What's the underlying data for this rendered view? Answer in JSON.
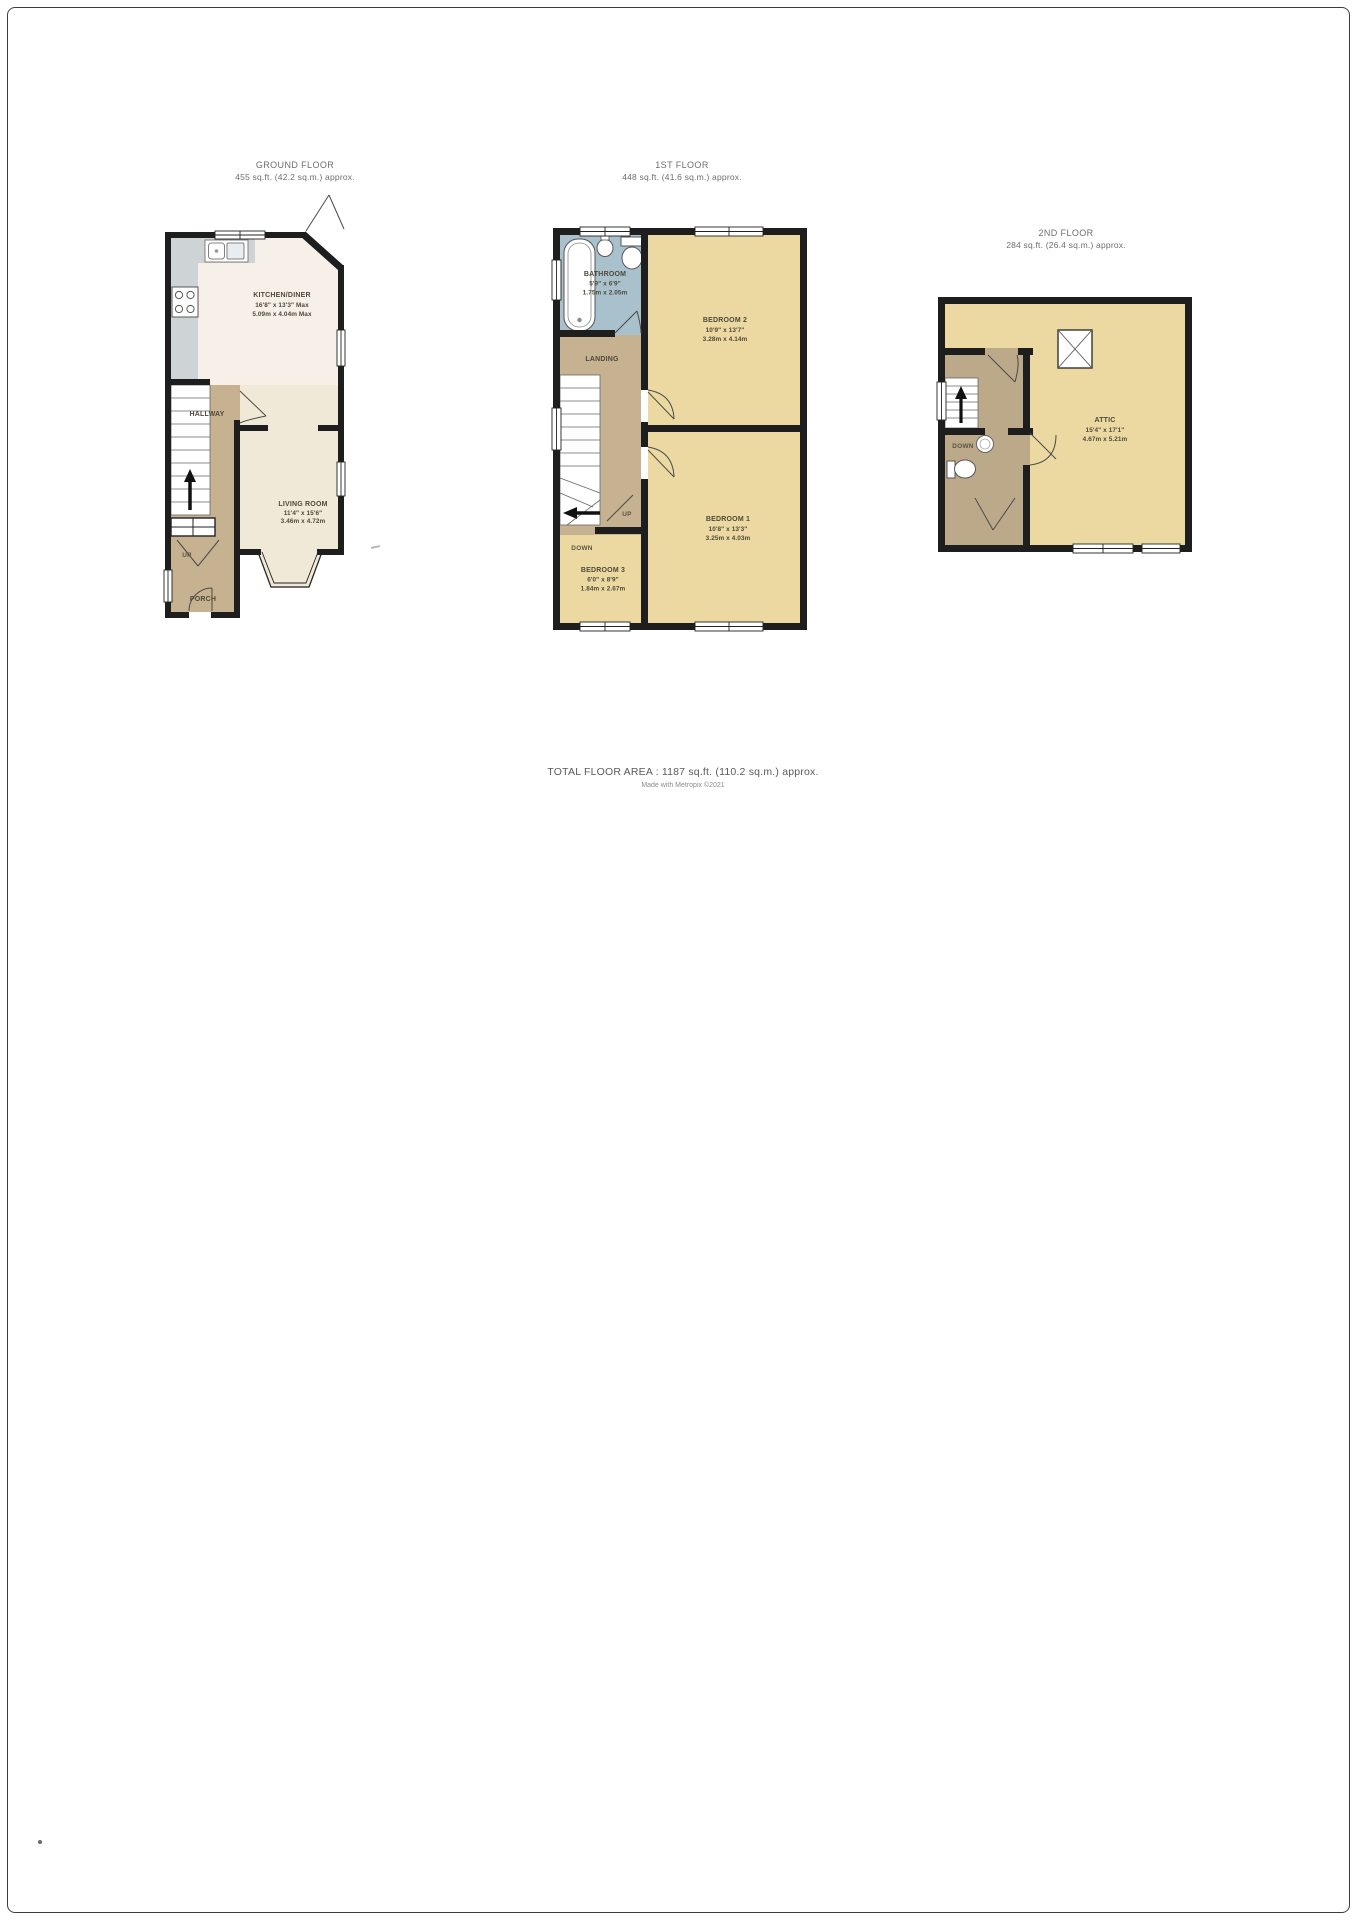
{
  "floors": [
    {
      "title": "GROUND FLOOR",
      "subtitle": "455 sq.ft. (42.2 sq.m.) approx."
    },
    {
      "title": "1ST FLOOR",
      "subtitle": "448 sq.ft. (41.6 sq.m.) approx."
    },
    {
      "title": "2ND FLOOR",
      "subtitle": "284 sq.ft. (26.4 sq.m.) approx."
    }
  ],
  "rooms": {
    "kitchen_diner": {
      "name": "KITCHEN/DINER",
      "imperial": "16'8\" x 13'3\" Max",
      "metric": "5.09m x 4.04m Max"
    },
    "living_room": {
      "name": "LIVING ROOM",
      "imperial": "11'4\" x 15'6\"",
      "metric": "3.46m x 4.72m"
    },
    "hallway": {
      "name": "HALLWAY"
    },
    "porch": {
      "name": "PORCH"
    },
    "bathroom": {
      "name": "BATHROOM",
      "imperial": "5'9\" x 6'9\"",
      "metric": "1.75m x 2.05m"
    },
    "landing": {
      "name": "LANDING"
    },
    "bedroom_1": {
      "name": "BEDROOM 1",
      "imperial": "10'8\" x 13'3\"",
      "metric": "3.25m x 4.03m"
    },
    "bedroom_2": {
      "name": "BEDROOM 2",
      "imperial": "10'9\" x 13'7\"",
      "metric": "3.28m x 4.14m"
    },
    "bedroom_3": {
      "name": "BEDROOM 3",
      "imperial": "6'0\" x 8'9\"",
      "metric": "1.84m x 2.67m"
    },
    "attic": {
      "name": "ATTIC",
      "imperial": "15'4\" x 17'1\"",
      "metric": "4.67m x 5.21m"
    }
  },
  "stair_labels": {
    "up": "UP",
    "down": "DOWN"
  },
  "footer": {
    "total": "TOTAL FLOOR AREA : 1187 sq.ft. (110.2 sq.m.) approx.",
    "credit": "Made with Metropix ©2021"
  },
  "colors": {
    "wall": "#1e1e1e",
    "bedroom_yellow": "#ecd9a2",
    "hall_tan": "#c6b290",
    "upper_tan": "#bba98a",
    "bathroom_blue": "#a8c1cc",
    "living_cream": "#f1e9d7",
    "kitchen_floor": "#f6f0e8",
    "counter_grey": "#ced3d6"
  }
}
